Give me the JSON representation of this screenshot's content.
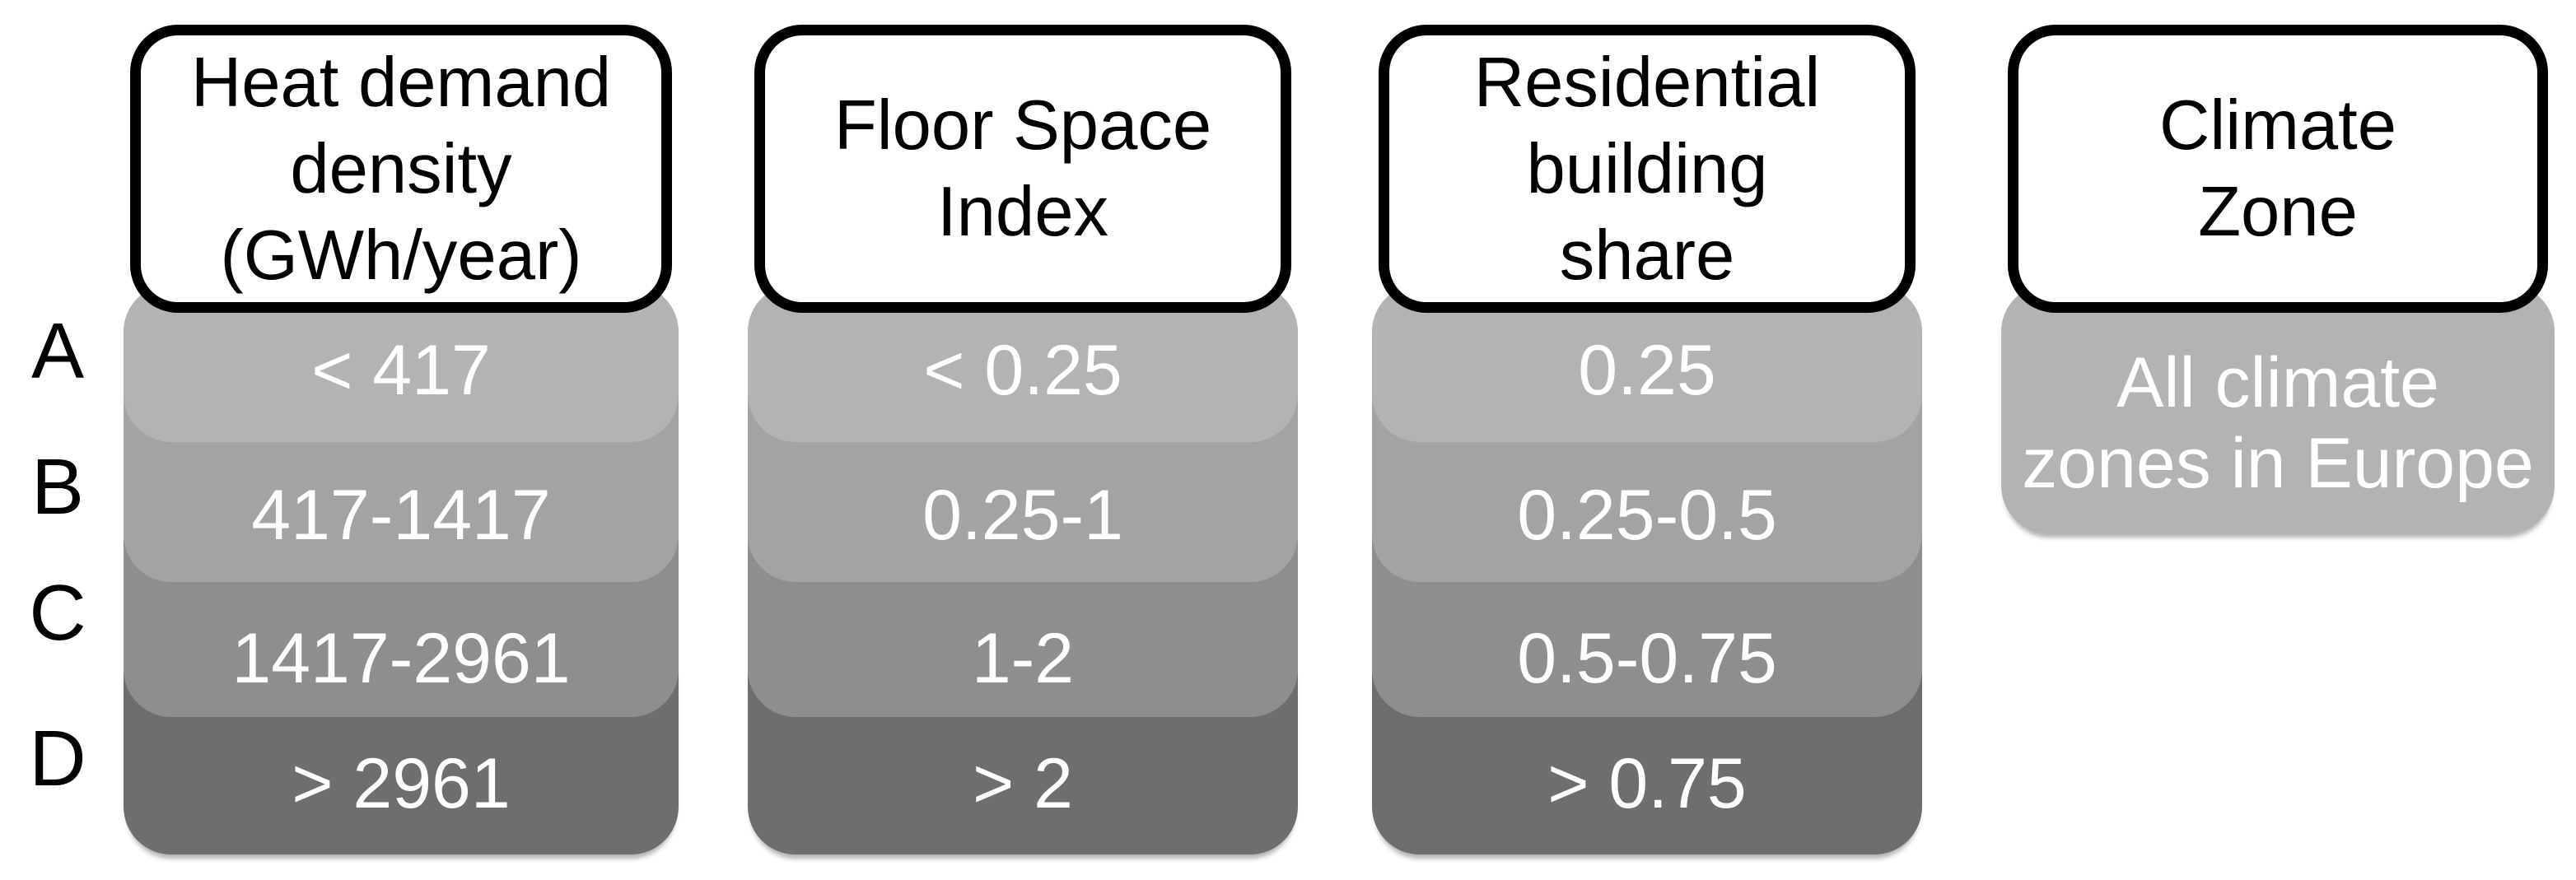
{
  "figure": {
    "description_rows": [
      "A",
      "B",
      "C",
      "D"
    ]
  },
  "row_labels": [
    "A",
    "B",
    "C",
    "D"
  ],
  "columns": [
    {
      "id": "heat-demand-density",
      "header_lines": [
        "Heat demand",
        "density",
        "(GWh/year)"
      ],
      "values": [
        "< 417",
        "417-1417",
        "1417-2961",
        "> 2961"
      ]
    },
    {
      "id": "floor-space-index",
      "header_lines": [
        "Floor Space",
        "Index"
      ],
      "values": [
        "< 0.25",
        "0.25-1",
        "1-2",
        "> 2"
      ]
    },
    {
      "id": "residential-building-share",
      "header_lines": [
        "Residential",
        "building",
        "share"
      ],
      "values": [
        "0.25",
        "0.25-0.5",
        "0.5-0.75",
        "> 0.75"
      ]
    },
    {
      "id": "climate-zone",
      "header_lines": [
        "Climate",
        "Zone"
      ],
      "value_lines": [
        "All climate",
        "zones in Europe"
      ]
    }
  ],
  "colors": {
    "row_a": "#b3b3b3",
    "row_b": "#a3a3a3",
    "row_c": "#8e8e8e",
    "row_d": "#6e6e6e",
    "climate_cell": "#b3b3b3",
    "header_bg": "#ffffff",
    "header_border": "#000000",
    "value_text": "#ffffff",
    "label_text": "#000000",
    "background": "#ffffff"
  }
}
